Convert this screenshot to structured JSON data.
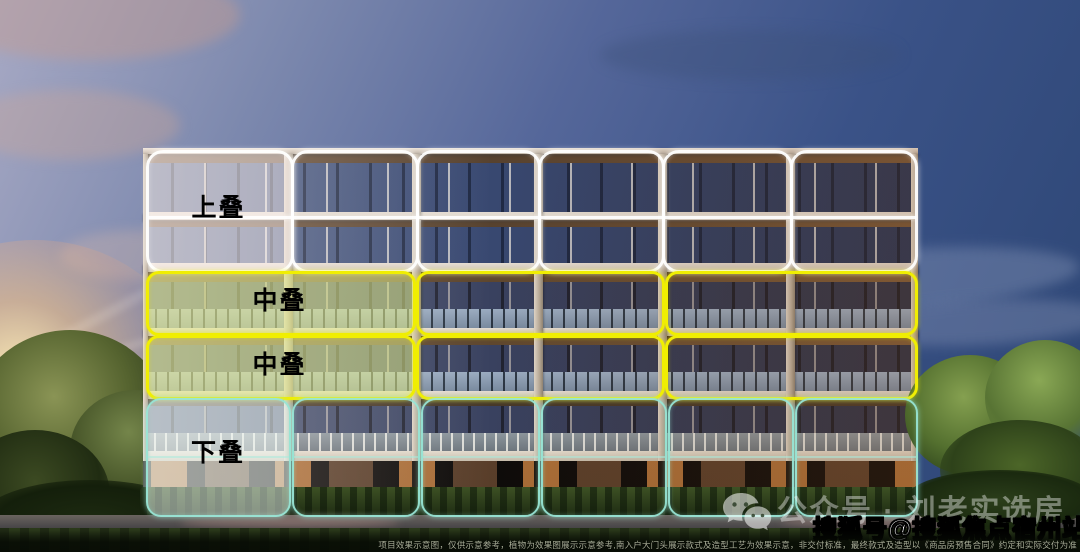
{
  "sections": {
    "upper": {
      "label": "上叠",
      "outline_color": "#ffffff",
      "units": 6,
      "floors": 2
    },
    "middle_row_1": {
      "label": "中叠",
      "outline_color": "#f0ee02",
      "units": 3,
      "floors": 1
    },
    "middle_row_2": {
      "label": "中叠",
      "outline_color": "#f0ee02",
      "units": 3,
      "floors": 1
    },
    "lower": {
      "label": "下叠",
      "outline_color": "#98e5d5",
      "units": 6,
      "floors": 2
    }
  },
  "watermarks": {
    "wechat_account": "公众号 · 刘老实选房",
    "sohu_badge": "搜狐号@搜狐焦点宿州站"
  },
  "footer": {
    "disclaimer": "项目效果示意图，仅供示意参考，植物为效果图展示示意参考,南入户大门头展示款式及造型工艺为效果示意，非交付标准，最终款式及造型以《商品房预售合同》约定和实际交付为准"
  }
}
